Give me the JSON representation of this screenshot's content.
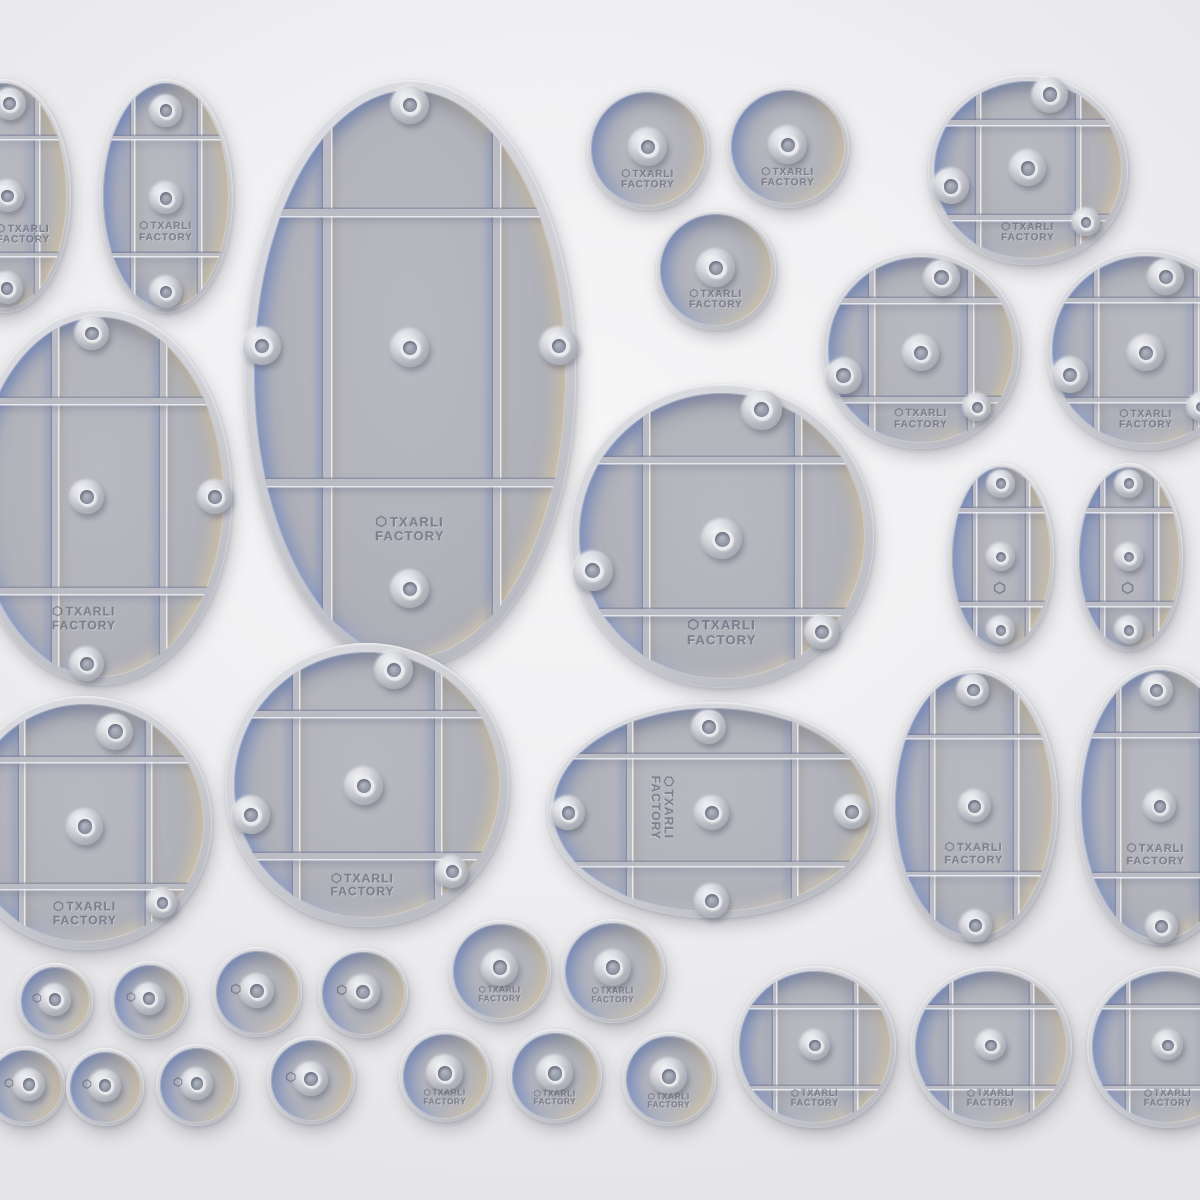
{
  "brand": {
    "line1": "TXARLI",
    "line2": "FACTORY",
    "mark": "hexagon-icon"
  },
  "palette": {
    "bg_center": "#f6f6f7",
    "bg_edge": "#e5e5e8",
    "shell": "#cdced4",
    "floor": "#b1b2ba",
    "floor_dark": "#a6a7b0",
    "rib": "#babbc3",
    "bevel_blue": "rgba(110,135,195,0.75)",
    "bevel_tan": "rgba(211,196,164,0.80)",
    "boss_light": "#f3f4f6",
    "boss_dark": "#9a9ca5",
    "hole": "#7a7f8c",
    "ring": "#e9ebef",
    "engrave": "#5f6174"
  },
  "bases": [
    {
      "name": "oval-base-small-partial-top-left",
      "cx": 3,
      "cy": 196,
      "rx": 68,
      "ry": 117,
      "ribs": true,
      "bosses": [
        [
          0.1,
          -0.79,
          16
        ],
        [
          0.07,
          0,
          16
        ],
        [
          0.06,
          0.79,
          16
        ]
      ],
      "label": {
        "type": "text",
        "fx": 0.3,
        "fy": 0.33,
        "size": 10
      }
    },
    {
      "name": "oval-base-small-top-left",
      "cx": 166,
      "cy": 196,
      "rx": 67,
      "ry": 117,
      "ribs": true,
      "bosses": [
        [
          0,
          -0.73,
          16
        ],
        [
          0,
          0.02,
          16
        ],
        [
          0,
          0.82,
          16
        ]
      ],
      "label": {
        "type": "text",
        "fx": 0,
        "fy": 0.31,
        "size": 10
      }
    },
    {
      "name": "oval-base-large",
      "cx": 410,
      "cy": 374,
      "rx": 166,
      "ry": 294,
      "ribs": {
        "v": [
          -0.5,
          0.52
        ],
        "h": [
          -0.55,
          0.37
        ]
      },
      "bosses": [
        [
          0,
          -0.915,
          19
        ],
        [
          -0.89,
          -0.095,
          19
        ],
        [
          0,
          -0.09,
          19
        ],
        [
          0.9,
          -0.095,
          19
        ],
        [
          0,
          0.73,
          19
        ]
      ],
      "label": {
        "type": "text",
        "fx": 0,
        "fy": 0.53,
        "size": 13
      }
    },
    {
      "name": "round-base-small-text-1",
      "cx": 648,
      "cy": 149,
      "r": 61,
      "bosses": [
        [
          0,
          -0.03,
          19
        ]
      ],
      "label": {
        "type": "text",
        "fx": 0,
        "fy": 0.5,
        "size": 10
      }
    },
    {
      "name": "round-base-small-text-2",
      "cx": 788,
      "cy": 147,
      "r": 61,
      "bosses": [
        [
          0,
          -0.03,
          19
        ]
      ],
      "label": {
        "type": "text",
        "fx": 0,
        "fy": 0.5,
        "size": 10
      }
    },
    {
      "name": "round-base-small-text-3",
      "cx": 716,
      "cy": 270,
      "r": 60,
      "bosses": [
        [
          0,
          -0.03,
          19
        ]
      ],
      "label": {
        "type": "text",
        "fx": 0,
        "fy": 0.5,
        "size": 10
      }
    },
    {
      "name": "round-base-grid-top-right",
      "cx": 1028,
      "cy": 170,
      "rx": 100,
      "ry": 95,
      "ribs": true,
      "bosses": [
        [
          0.22,
          -0.79,
          18
        ],
        [
          0,
          -0.02,
          18
        ],
        [
          -0.77,
          0.17,
          18
        ],
        [
          0.58,
          0.55,
          14
        ]
      ],
      "label": {
        "type": "text",
        "fx": 0,
        "fy": 0.66,
        "size": 10
      }
    },
    {
      "name": "round-base-grid-mid-right-1",
      "cx": 921,
      "cy": 350,
      "r": 99,
      "ribs": true,
      "bosses": [
        [
          0.21,
          -0.73,
          18
        ],
        [
          0,
          0.03,
          18
        ],
        [
          -0.78,
          0.26,
          18
        ],
        [
          0.57,
          0.58,
          14
        ]
      ],
      "label": {
        "type": "text",
        "fx": 0,
        "fy": 0.7,
        "size": 10
      }
    },
    {
      "name": "round-base-grid-mid-right-2-partial",
      "cx": 1146,
      "cy": 350,
      "r": 100,
      "ribs": true,
      "bosses": [
        [
          0.2,
          -0.73,
          18
        ],
        [
          0,
          0.03,
          18
        ],
        [
          -0.76,
          0.25,
          18
        ],
        [
          0.55,
          0.57,
          14
        ]
      ],
      "label": {
        "type": "text",
        "fx": 0,
        "fy": 0.7,
        "size": 10
      }
    },
    {
      "name": "oval-base-medium-partial-left",
      "cx": 100,
      "cy": 497,
      "rx": 132,
      "ry": 188,
      "ribs": {
        "v": [
          -0.34,
          0.48
        ],
        "h": [
          -0.51,
          0.5
        ]
      },
      "bosses": [
        [
          -0.06,
          -0.87,
          17
        ],
        [
          -0.1,
          0,
          17
        ],
        [
          0.87,
          0,
          17
        ],
        [
          -0.1,
          0.89,
          17
        ]
      ],
      "label": {
        "type": "text",
        "fx": -0.12,
        "fy": 0.65,
        "size": 12
      }
    },
    {
      "name": "round-base-large-grid-center",
      "cx": 722,
      "cy": 536,
      "r": 152,
      "ribs": true,
      "bosses": [
        [
          0.26,
          -0.83,
          20
        ],
        [
          0,
          0.02,
          20
        ],
        [
          -0.85,
          0.23,
          20
        ],
        [
          0.66,
          0.63,
          17
        ]
      ],
      "label": {
        "type": "text",
        "fx": 0,
        "fy": 0.64,
        "size": 13
      }
    },
    {
      "name": "pill-base-tiny-1",
      "cx": 1001,
      "cy": 557,
      "rx": 53,
      "ry": 94,
      "ribs": true,
      "bosses": [
        [
          0,
          -0.78,
          14
        ],
        [
          0,
          0,
          14
        ],
        [
          0,
          0.78,
          14
        ]
      ],
      "label": {
        "type": "hex",
        "fx": 0,
        "fy": 0.33,
        "size": 13
      }
    },
    {
      "name": "pill-base-tiny-2",
      "cx": 1129,
      "cy": 557,
      "rx": 54,
      "ry": 94,
      "ribs": true,
      "bosses": [
        [
          0,
          -0.78,
          14
        ],
        [
          0,
          0,
          14
        ],
        [
          0,
          0.78,
          14
        ]
      ],
      "label": {
        "type": "hex",
        "fx": 0,
        "fy": 0.33,
        "size": 13
      }
    },
    {
      "name": "round-base-grid-partial-bottom-left",
      "cx": 85,
      "cy": 823,
      "r": 127,
      "ribs": true,
      "bosses": [
        [
          0.24,
          -0.72,
          18
        ],
        [
          0,
          0.03,
          18
        ],
        [
          0.61,
          0.63,
          15
        ]
      ],
      "label": {
        "type": "text",
        "fx": 0,
        "fy": 0.72,
        "size": 12
      }
    },
    {
      "name": "round-base-large-grid-bottom",
      "cx": 367,
      "cy": 785,
      "r": 142,
      "ribs": true,
      "bosses": [
        [
          0.19,
          -0.81,
          19
        ],
        [
          -0.02,
          0.01,
          19
        ],
        [
          -0.82,
          0.21,
          19
        ],
        [
          0.6,
          0.61,
          16
        ]
      ],
      "label": {
        "type": "text",
        "fx": -0.03,
        "fy": 0.71,
        "size": 12
      }
    },
    {
      "name": "oval-base-landscape",
      "cx": 712,
      "cy": 810,
      "rx": 165,
      "ry": 108,
      "ribs": true,
      "bosses": [
        [
          -0.02,
          -0.77,
          17
        ],
        [
          0,
          0.03,
          17
        ],
        [
          -0.87,
          0.03,
          17
        ],
        [
          0.85,
          0.02,
          17
        ],
        [
          0,
          0.84,
          17
        ]
      ],
      "label": {
        "type": "text-rot",
        "fx": -0.31,
        "fy": -0.02,
        "size": 12
      }
    },
    {
      "name": "pill-base-medium-1",
      "cx": 974,
      "cy": 805,
      "rx": 84,
      "ry": 137,
      "ribs": true,
      "bosses": [
        [
          -0.01,
          -0.84,
          16
        ],
        [
          0.01,
          0.01,
          16
        ],
        [
          0.02,
          0.88,
          16
        ]
      ],
      "label": {
        "type": "text",
        "fx": 0,
        "fy": 0.36,
        "size": 11
      }
    },
    {
      "name": "pill-base-medium-2-partial",
      "cx": 1160,
      "cy": 805,
      "rx": 84,
      "ry": 140,
      "ribs": true,
      "bosses": [
        [
          -0.04,
          -0.82,
          16
        ],
        [
          0,
          0.01,
          16
        ],
        [
          0.02,
          0.87,
          16
        ]
      ],
      "label": {
        "type": "text",
        "fx": -0.05,
        "fy": 0.36,
        "size": 11
      }
    },
    {
      "name": "round-base-tiny-1",
      "cx": 55,
      "cy": 1001,
      "r": 38,
      "bosses": [
        [
          0,
          -0.03,
          16
        ]
      ],
      "label": {
        "type": "hex",
        "fx": -0.44,
        "fy": -0.08,
        "size": 10
      }
    },
    {
      "name": "round-base-tiny-2",
      "cx": 149,
      "cy": 1000,
      "r": 39,
      "bosses": [
        [
          0,
          -0.03,
          16
        ]
      ],
      "label": {
        "type": "hex",
        "fx": -0.44,
        "fy": -0.08,
        "size": 10
      }
    },
    {
      "name": "round-base-tiny-3",
      "cx": 257,
      "cy": 992,
      "r": 45,
      "bosses": [
        [
          0,
          -0.03,
          17
        ]
      ],
      "label": {
        "type": "hex",
        "fx": -0.44,
        "fy": -0.06,
        "size": 11
      }
    },
    {
      "name": "round-base-tiny-4",
      "cx": 363,
      "cy": 993,
      "r": 45,
      "bosses": [
        [
          0,
          -0.03,
          17
        ]
      ],
      "label": {
        "type": "hex",
        "fx": -0.44,
        "fy": -0.06,
        "size": 11
      }
    },
    {
      "name": "round-base-tiny-text-1",
      "cx": 500,
      "cy": 971,
      "r": 51,
      "bosses": [
        [
          0,
          -0.06,
          18
        ]
      ],
      "label": {
        "type": "text",
        "fx": 0,
        "fy": 0.48,
        "size": 8
      }
    },
    {
      "name": "round-base-tiny-text-2",
      "cx": 613,
      "cy": 971,
      "r": 52,
      "bosses": [
        [
          0,
          -0.06,
          18
        ]
      ],
      "label": {
        "type": "text",
        "fx": 0,
        "fy": 0.48,
        "size": 8
      }
    },
    {
      "name": "round-base-tiny-5-partial",
      "cx": 25,
      "cy": 1086,
      "r": 40,
      "bosses": [
        [
          0.1,
          -0.03,
          16
        ]
      ],
      "label": {
        "type": "hex",
        "fx": -0.38,
        "fy": -0.08,
        "size": 10
      }
    },
    {
      "name": "round-base-tiny-6",
      "cx": 105,
      "cy": 1087,
      "r": 39,
      "bosses": [
        [
          0,
          -0.03,
          16
        ]
      ],
      "label": {
        "type": "hex",
        "fx": -0.44,
        "fy": -0.08,
        "size": 10
      }
    },
    {
      "name": "round-base-tiny-7",
      "cx": 197,
      "cy": 1085,
      "r": 41,
      "bosses": [
        [
          0,
          -0.03,
          16
        ]
      ],
      "label": {
        "type": "hex",
        "fx": -0.44,
        "fy": -0.08,
        "size": 10
      }
    },
    {
      "name": "round-base-tiny-8",
      "cx": 311,
      "cy": 1080,
      "r": 44,
      "bosses": [
        [
          0,
          -0.03,
          17
        ]
      ],
      "label": {
        "type": "hex",
        "fx": -0.44,
        "fy": -0.06,
        "size": 11
      }
    },
    {
      "name": "round-base-tiny-text-3",
      "cx": 445,
      "cy": 1076,
      "r": 46,
      "bosses": [
        [
          0,
          -0.06,
          18
        ]
      ],
      "label": {
        "type": "text",
        "fx": 0,
        "fy": 0.48,
        "size": 8
      }
    },
    {
      "name": "round-base-tiny-text-4",
      "cx": 555,
      "cy": 1076,
      "r": 47,
      "bosses": [
        [
          0,
          -0.06,
          18
        ]
      ],
      "label": {
        "type": "text",
        "fx": 0,
        "fy": 0.48,
        "size": 8
      }
    },
    {
      "name": "round-base-tiny-text-5",
      "cx": 669,
      "cy": 1079,
      "r": 47,
      "bosses": [
        [
          0,
          -0.06,
          18
        ]
      ],
      "label": {
        "type": "text",
        "fx": 0,
        "fy": 0.48,
        "size": 8
      }
    },
    {
      "name": "round-base-grid-bottom-1",
      "cx": 815,
      "cy": 1047,
      "r": 81,
      "ribs": true,
      "bosses": [
        [
          0,
          -0.02,
          15
        ]
      ],
      "label": {
        "type": "text",
        "fx": 0,
        "fy": 0.63,
        "size": 9
      }
    },
    {
      "name": "round-base-grid-bottom-2",
      "cx": 991,
      "cy": 1047,
      "r": 81,
      "ribs": true,
      "bosses": [
        [
          0,
          -0.02,
          15
        ]
      ],
      "label": {
        "type": "text",
        "fx": 0,
        "fy": 0.63,
        "size": 9
      }
    },
    {
      "name": "round-base-grid-bottom-3-partial",
      "cx": 1168,
      "cy": 1047,
      "r": 81,
      "ribs": true,
      "bosses": [
        [
          0,
          -0.02,
          15
        ]
      ],
      "label": {
        "type": "text",
        "fx": 0,
        "fy": 0.63,
        "size": 9
      }
    }
  ]
}
